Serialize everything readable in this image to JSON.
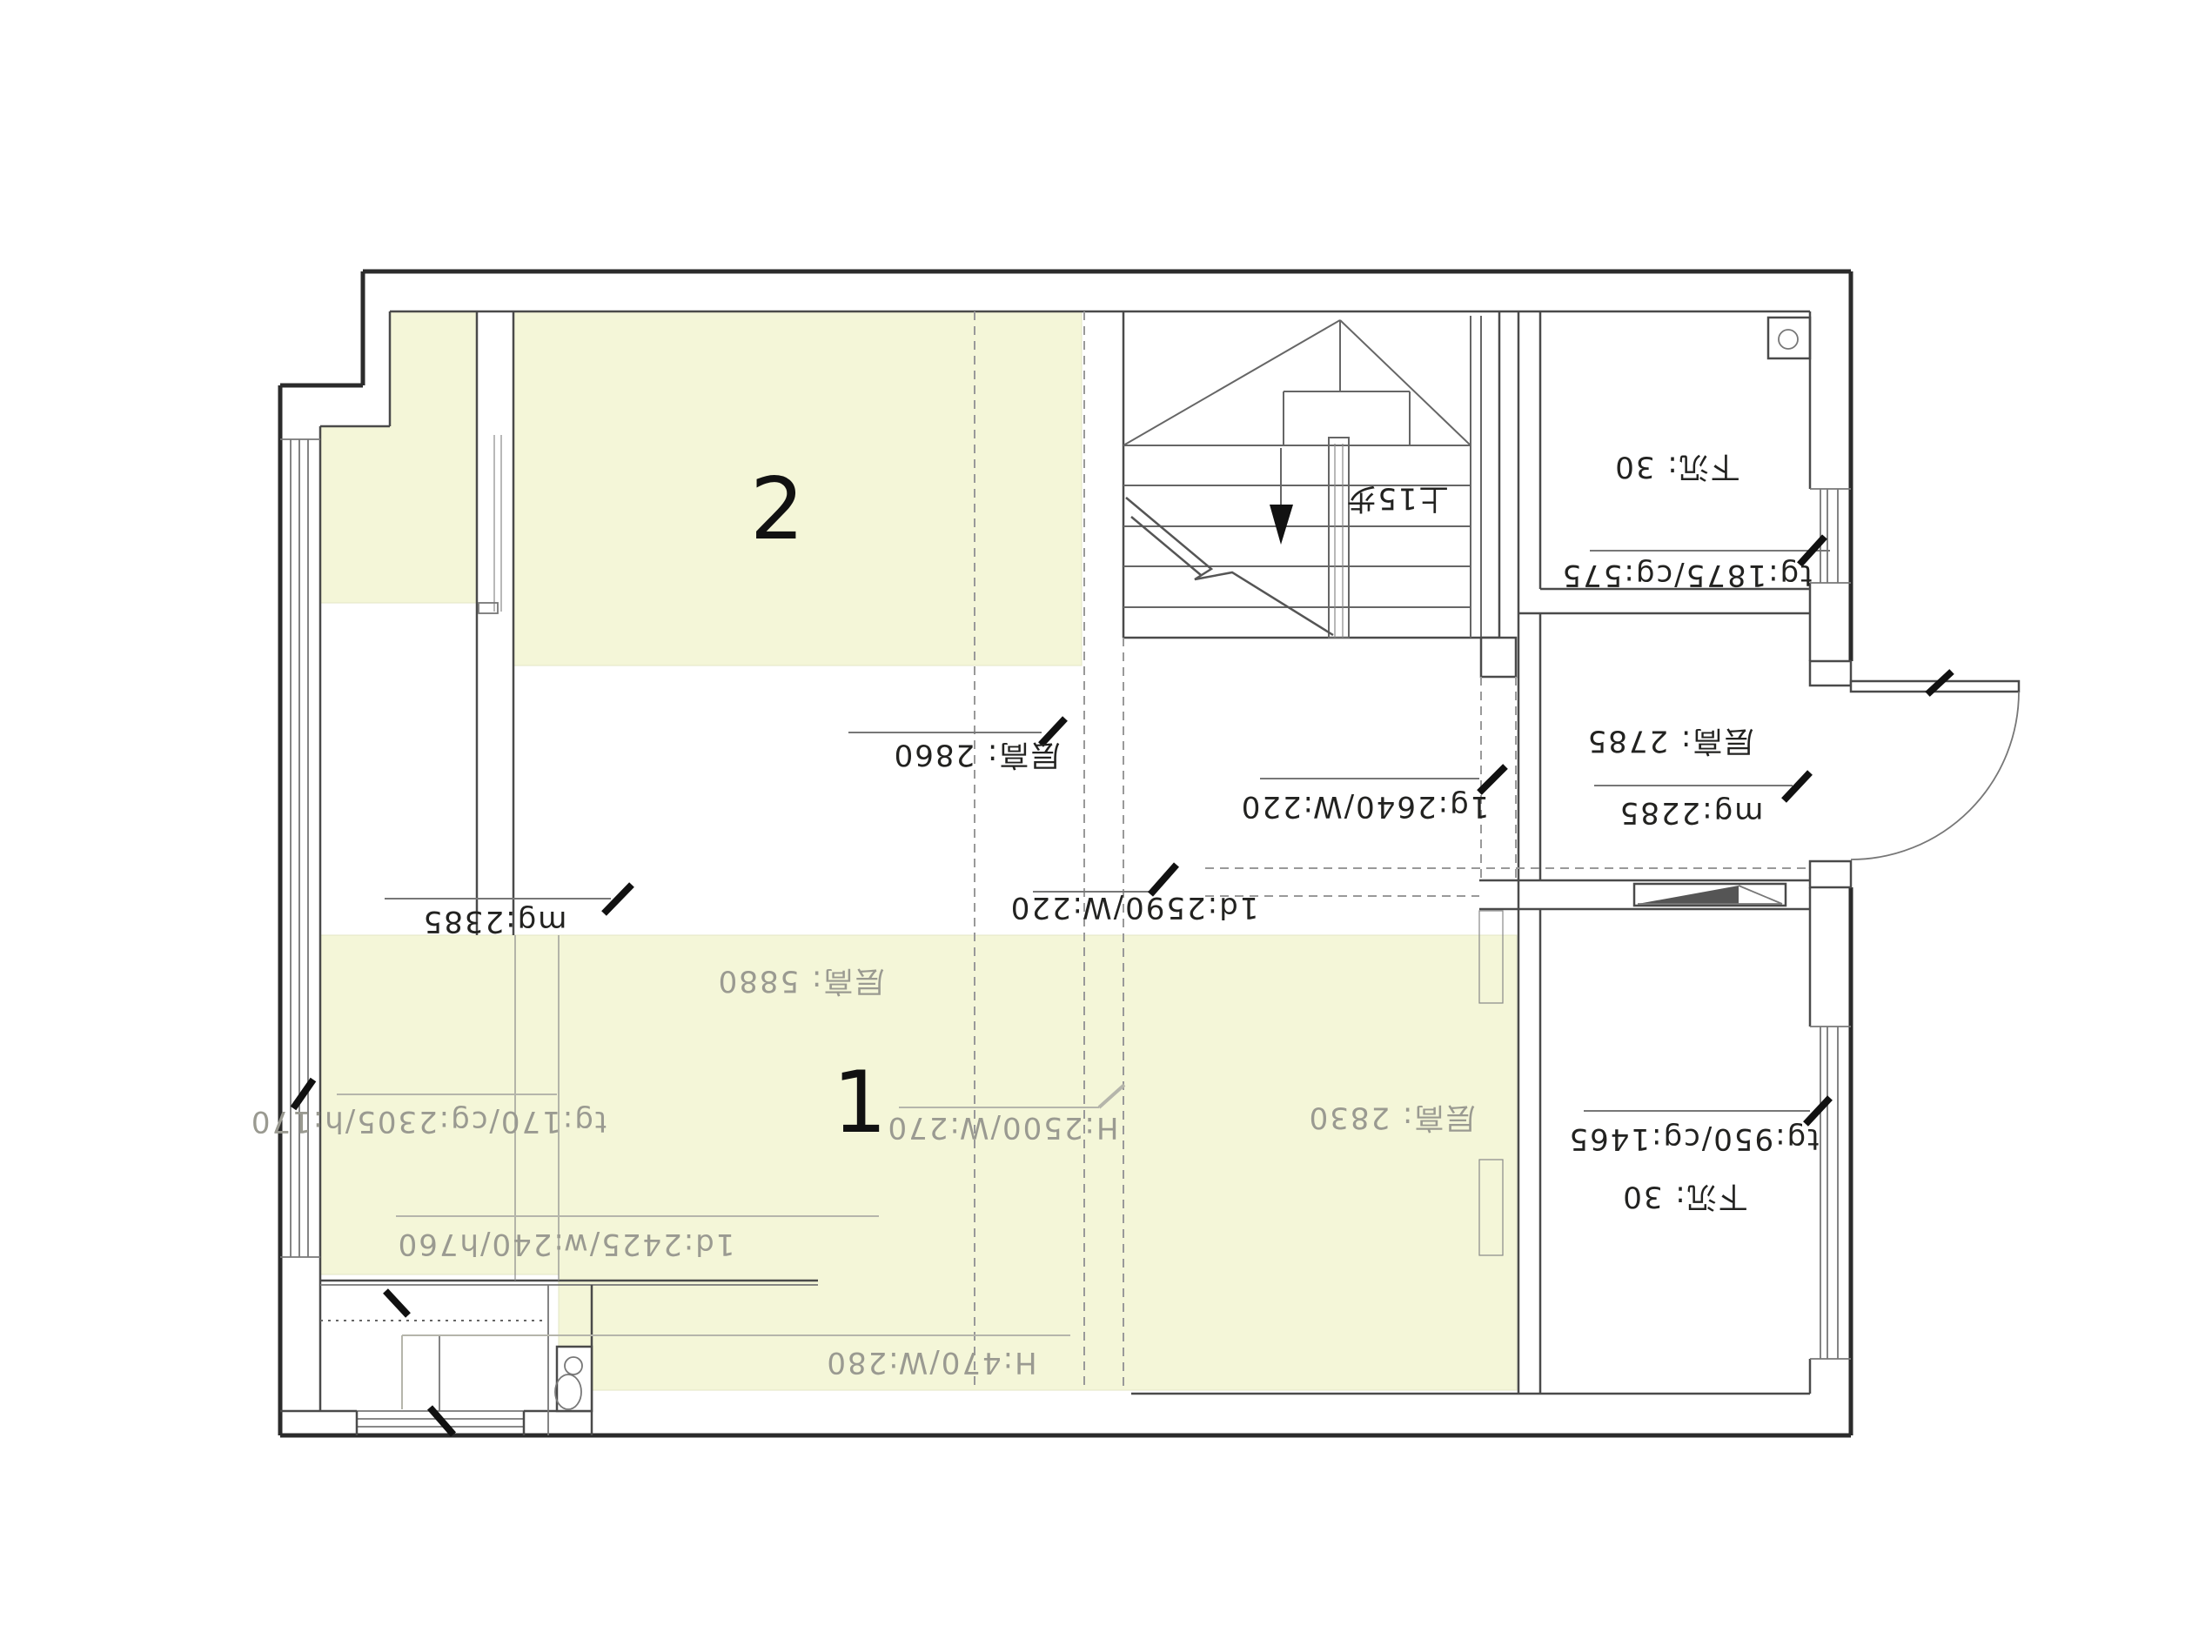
{
  "plan": {
    "title": "floor-plan",
    "rooms": {
      "room1_number": "1",
      "room2_number": "2"
    },
    "annotations": {
      "stairs_up": "上15步",
      "ceiling_2860": "层高: 2860",
      "ceiling_5880": "层高: 5880",
      "ceiling_2785": "层高: 2785",
      "ceiling_2830": "层高: 2830",
      "beam_1g_2640": "1g:2640/W:220",
      "beam_1d_2590": "1d:2590/W:220",
      "beam_1d_2425": "1d:2425/w:240/h760",
      "mg_2385": "mg:2385",
      "mg_2285": "mg:2285",
      "tg_1875": "tg:1875/cg:575",
      "tg_950": "tg:950/cg:1465",
      "tg_170": "tg:170/cg:2305/h:170",
      "window_h2500": "H:2500/W:270",
      "window_h470": "H:470/W:280",
      "sunken_30_top": "下沉: 30",
      "sunken_30_bottom": "下沉: 30"
    },
    "colors": {
      "highlight_region": "#F4F6D8",
      "gray_text": "#9a9a91",
      "dark_text": "#222220",
      "wall_line": "#2b2b2b",
      "background": "#ffffff"
    }
  }
}
